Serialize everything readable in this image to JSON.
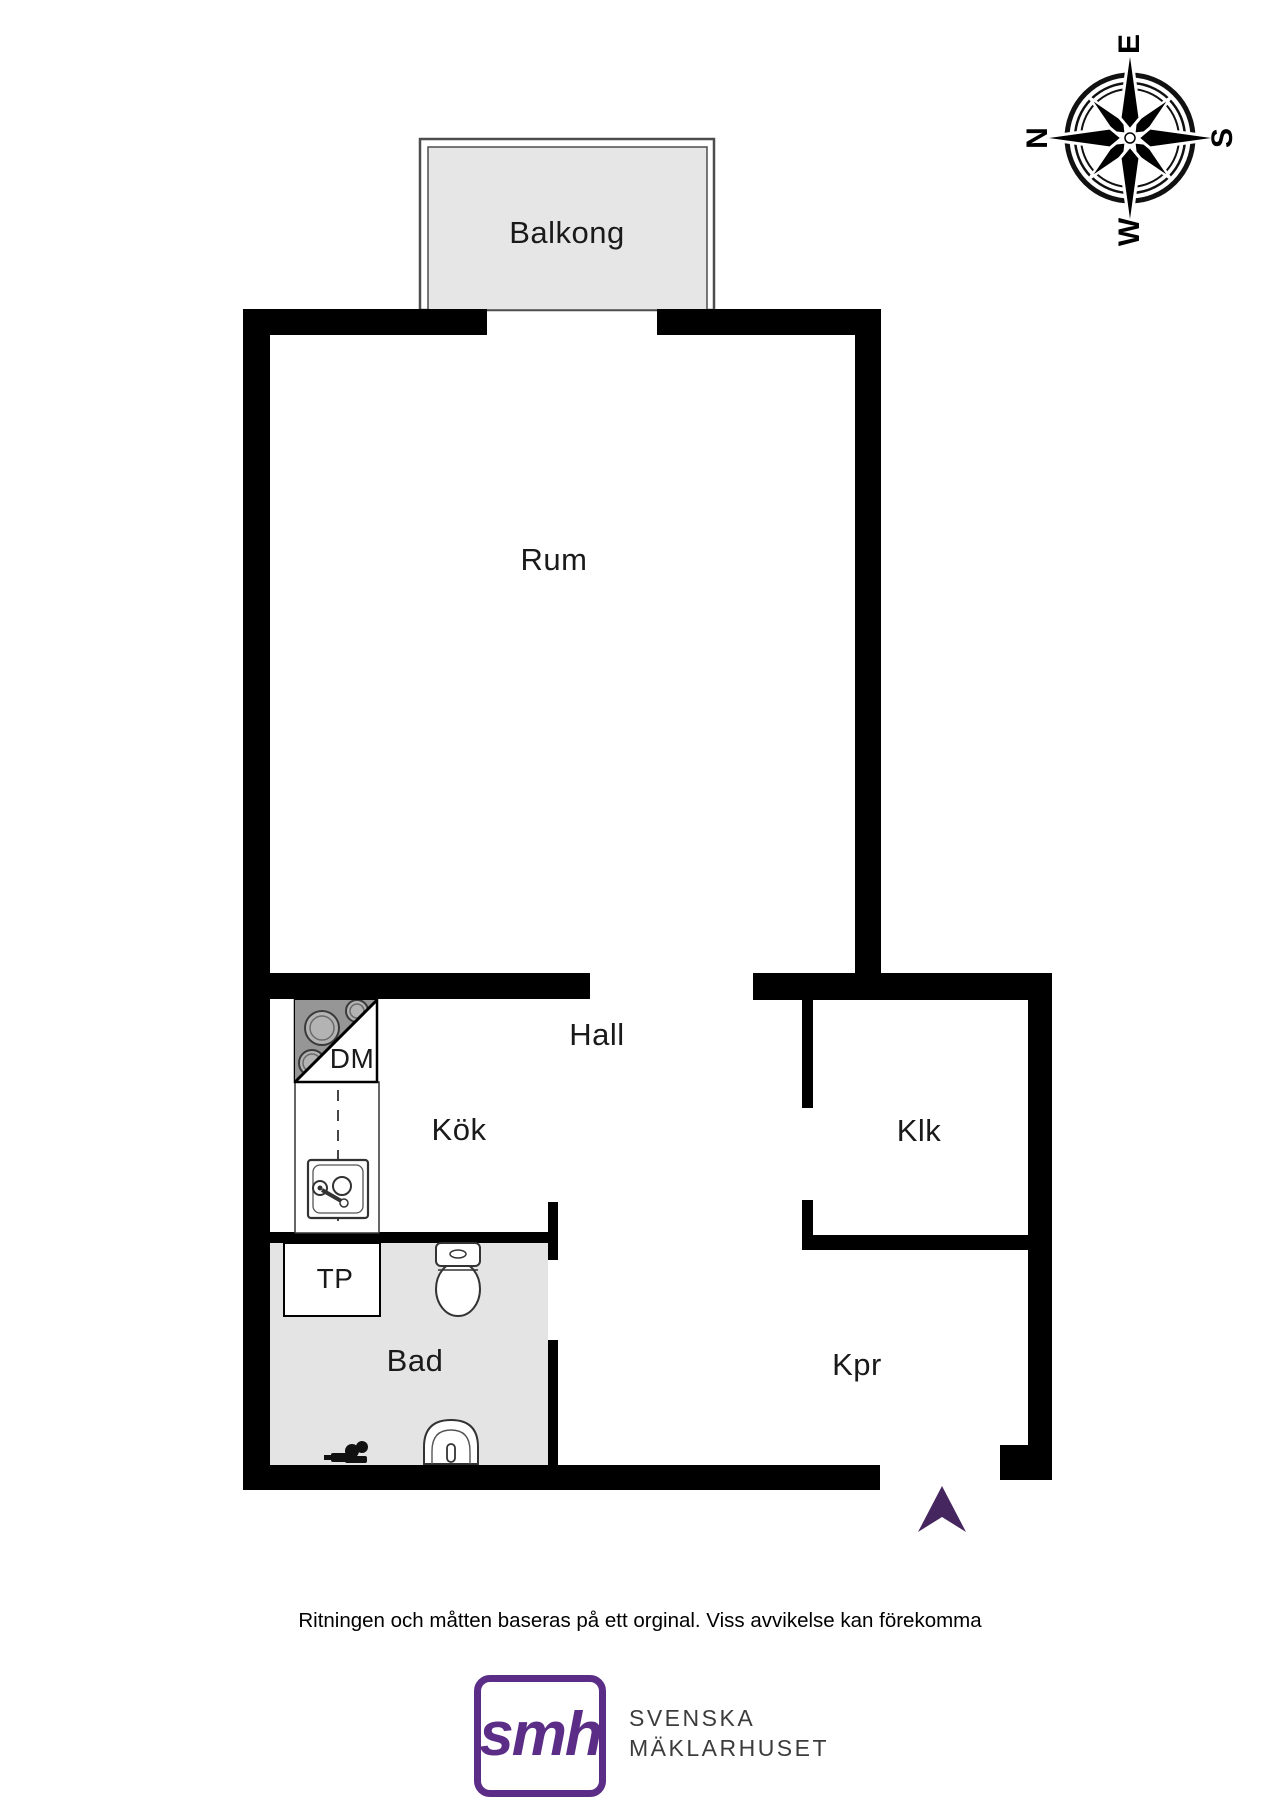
{
  "compass": {
    "north": "N",
    "east": "E",
    "south": "S",
    "west": "W"
  },
  "rooms": {
    "balkong": "Balkong",
    "rum": "Rum",
    "kok": "Kök",
    "hall": "Hall",
    "klk": "Klk",
    "bad": "Bad",
    "kpr": "Kpr",
    "dm": "DM",
    "tp": "TP"
  },
  "footer": {
    "disclaimer": "Ritningen och måtten baseras på ett orginal. Viss avvikelse kan förekomma"
  },
  "logo": {
    "mark": "smh",
    "line1": "SVENSKA",
    "line2": "MÄKLARHUSET"
  },
  "colors": {
    "wall": "#000000",
    "balcony_floor": "#e6e6e6",
    "bath_floor": "#e4e4e4",
    "stove_gray": "#969696",
    "brand_purple": "#5b2d87",
    "entry_arrow_purple": "#46265f"
  }
}
